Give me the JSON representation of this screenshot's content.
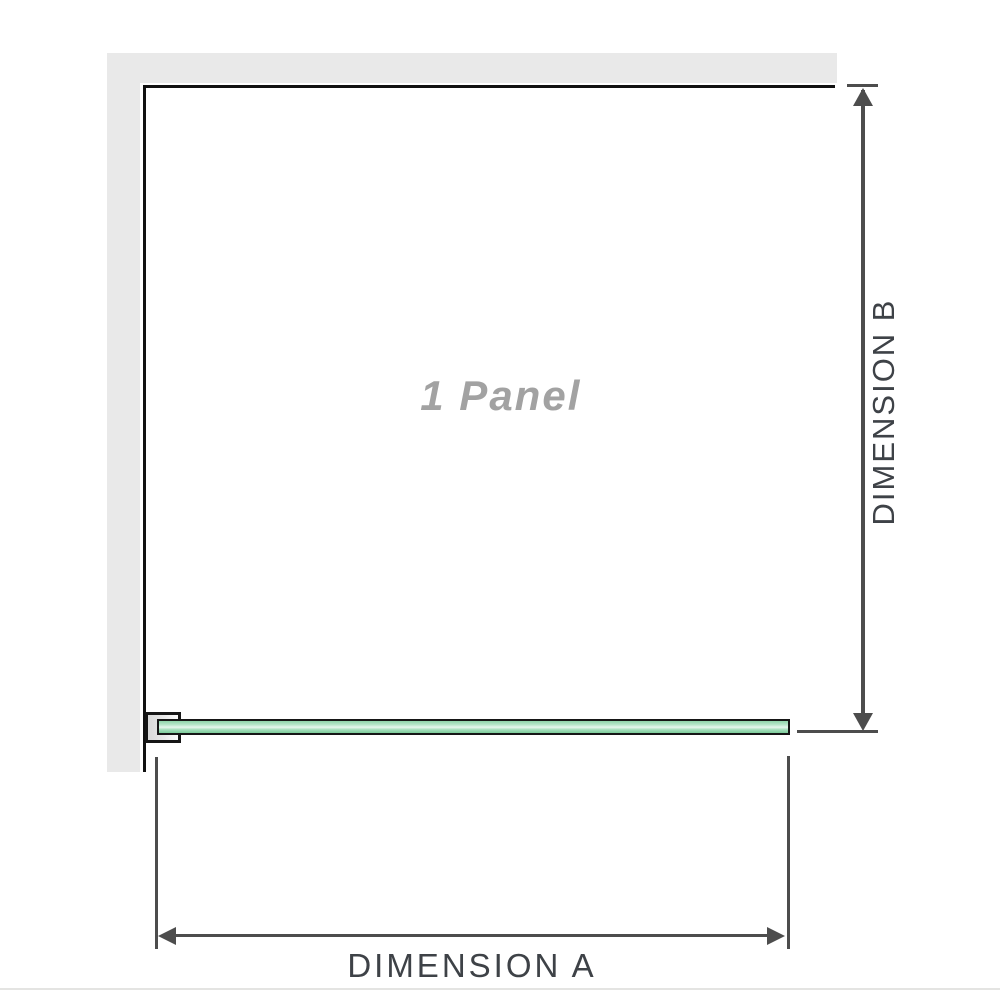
{
  "diagram": {
    "panel_label": "1 Panel",
    "dimension_a_label": "DIMENSION A",
    "dimension_b_label": "DIMENSION B"
  },
  "colors": {
    "wall_fill": "#e9e9e9",
    "panel_border": "#111111",
    "dimension_line": "#4d4d4d",
    "dimension_text": "#3e4247",
    "panel_label_text": "#a2a2a2",
    "glass_green": "#8fd4a9",
    "glass_green_light": "#e7f7ee",
    "glass_outline": "#161616",
    "bracket_fill": "#d9d9d9",
    "page_line": "#e4e4e2"
  }
}
